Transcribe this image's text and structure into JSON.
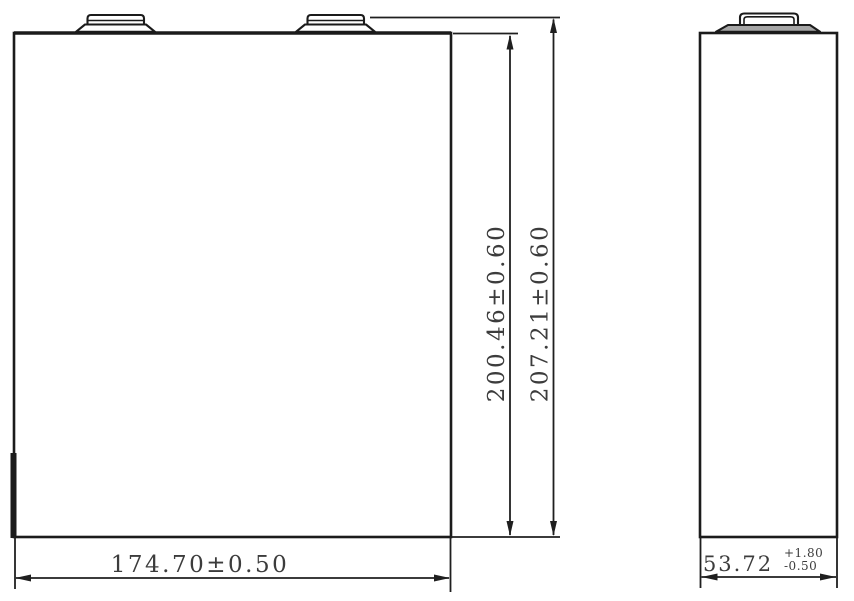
{
  "colors": {
    "line": "#1b1b1b",
    "text": "#3c3c3c",
    "terminal_fill": "#a6a6a6",
    "background": "#ffffff"
  },
  "dimensions": {
    "body_height": "200.46±0.60",
    "total_height": "207.21±0.60",
    "width": "174.70±0.50",
    "thickness_value": "53.72",
    "thickness_tol_upper": "+1.80",
    "thickness_tol_lower": "-0.50"
  }
}
